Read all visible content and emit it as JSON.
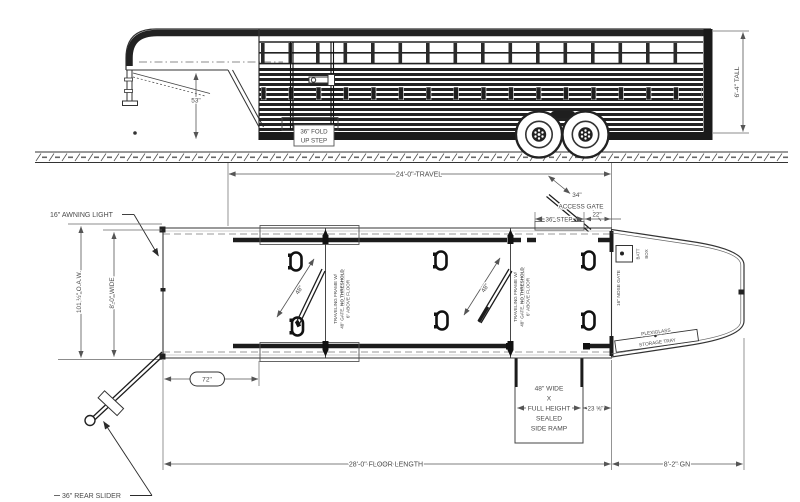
{
  "colors": {
    "line": "#333333",
    "dim": "#4a4a4a",
    "dark": "#1a1a1a",
    "bg": "#ffffff"
  },
  "side": {
    "dim_height": "53\"",
    "dim_tall": "6'-4\" TALL",
    "fold_step_l1": "36\" FOLD",
    "fold_step_l2": "UP STEP"
  },
  "plan": {
    "dim_travel": "24'-0\" TRAVEL",
    "awning": "16\" AWNING LIGHT",
    "dim_oaw": "101 ½\" O.A.W.",
    "dim_wide": "8'-0\" WIDE",
    "gate34_l1": "34\"",
    "gate34_l2": "ACCESS GATE",
    "dim_step": "36\" STEP",
    "dim_22": "22\"",
    "dim_72": "72\"",
    "gate48": "48\"",
    "note_l1": "TRAVELING FRAME W/",
    "note_l2a": "48\" GATE, ",
    "note_l2b": "NO THRESHOLD",
    "note_l3": "6\" ABOVE FLOOR",
    "nose_gate": "16\" NOSE GATE",
    "batt": "BATT",
    "box": "BOX",
    "plexi_l1": "PLEXIGLASS",
    "plexi_l2": "STORAGE TRAY",
    "ramp_l1": "48\" WIDE",
    "ramp_l2": "X",
    "ramp_l3": "FULL HEIGHT",
    "ramp_l4": "SEALED",
    "ramp_l5": "SIDE RAMP",
    "dim_ramp_side": "23 ⅝\"",
    "rear_slider": "36\" REAR SLIDER",
    "dim_floor": "28'-0\" FLOOR LENGTH",
    "dim_gn": "8'-2\" GN"
  }
}
